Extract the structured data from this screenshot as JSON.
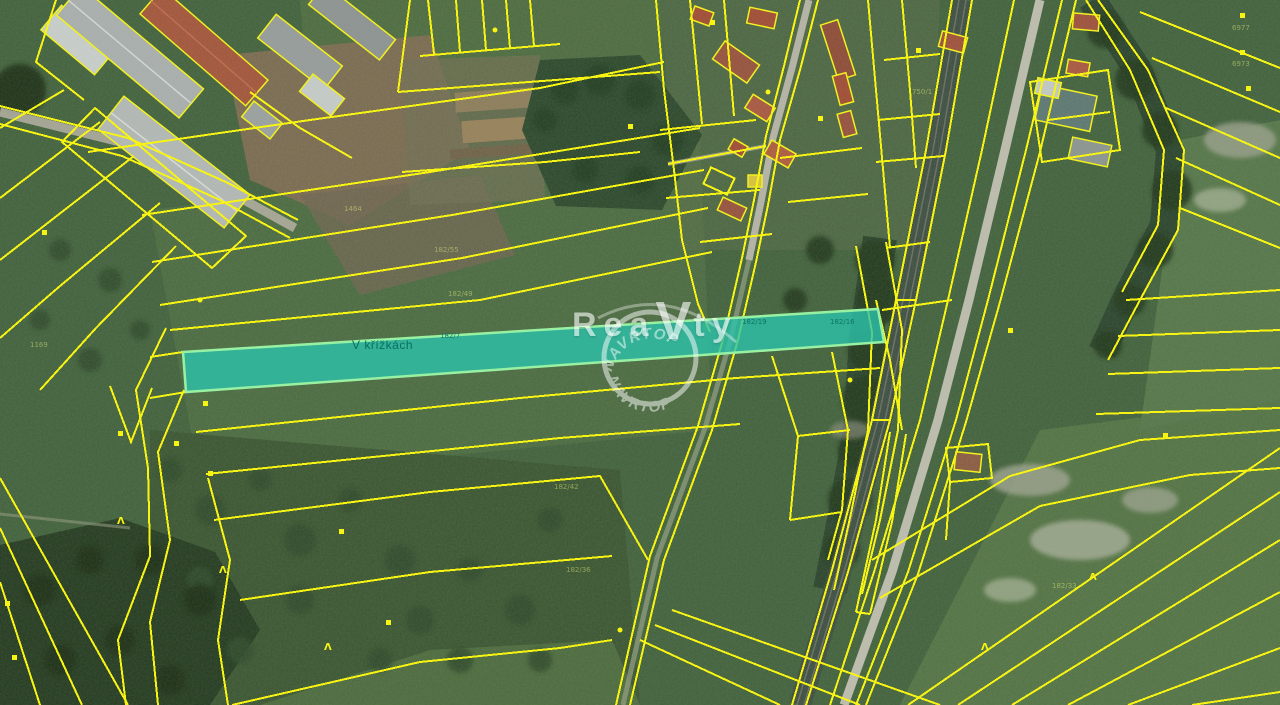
{
  "map": {
    "highlighted_parcel": {
      "label": "V křížkách"
    },
    "watermark": {
      "brand_prefix": "Rea",
      "brand_emphasis": "V",
      "brand_suffix": "ty",
      "stamp_arc_top": "NAVRTOP",
      "stamp_arc_bottom": "NAVRTOP"
    },
    "parcel_numbers": [
      {
        "text": "1464"
      },
      {
        "text": "182/55"
      },
      {
        "text": "182/49"
      },
      {
        "text": "1169"
      },
      {
        "text": "182/7"
      },
      {
        "text": "182/19"
      },
      {
        "text": "182/16"
      },
      {
        "text": "182/42"
      },
      {
        "text": "182/36"
      },
      {
        "text": "750/1"
      },
      {
        "text": "182/33"
      },
      {
        "text": "6977"
      },
      {
        "text": "6973"
      }
    ],
    "colors": {
      "cadastral_line": "#f7f414",
      "highlight_fill": "#2cc3ab",
      "highlight_border": "#98f1a2",
      "highlight_label_text": "#0a6e63",
      "watermark": "#ffffff"
    },
    "icons": {
      "parcel_marker": "small-square",
      "tree_symbol": "caret",
      "point_marker": "dot"
    }
  }
}
